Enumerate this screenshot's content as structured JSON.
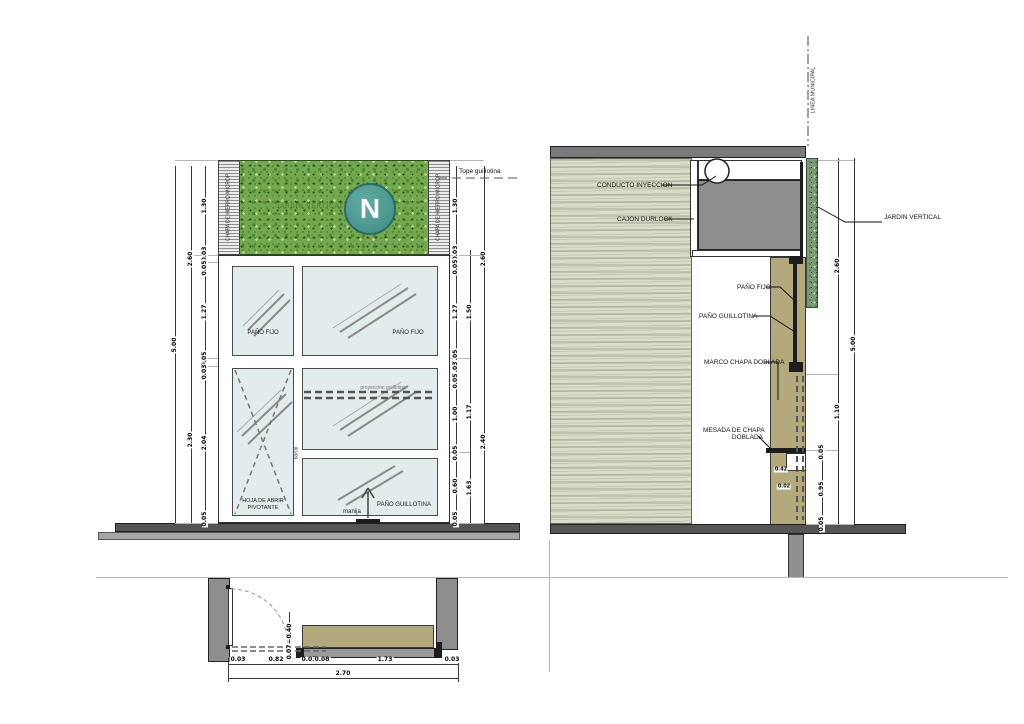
{
  "colors": {
    "garden_green": "#74a84e",
    "logo_teal": "#3f8a84",
    "khaki": "#b4a97c",
    "slab_gray": "#7a7a7a",
    "box_gray": "#8d8d8d",
    "floor_dark": "#555555",
    "glass": "#e2ecec"
  },
  "elevation": {
    "tope_label": "Tope guillotina",
    "garden_text": "JARDIN VERTICAL",
    "logo_letter": "N",
    "hatch_text": "CHAPA DE HIERRO MICROP.",
    "pane_fijo_left": "PAÑO FIJO",
    "pane_fijo_right": "PAÑO FIJO",
    "pane_guillotina": "PAÑO GUILLOTINA",
    "pivot_line1": "HOJA DE ABRIR",
    "pivot_line2": "PIVOTANTE",
    "handle": "manija",
    "projection": "proyeccion guillotina",
    "mullion": "barral",
    "dims_left_outer": [
      "5.00"
    ],
    "dims_left_mid": [
      "2.60",
      "2.30"
    ],
    "dims_left_inner": [
      "1.30",
      "0.03",
      "0.05",
      "1.27",
      "0.05",
      "0.03",
      "2.04",
      "0.05"
    ],
    "dims_right_inner": [
      "1.30",
      "0.03",
      "0.05",
      "1.27",
      "0.05",
      "0.03",
      "0.05",
      "1.00",
      "0.05",
      "0.60",
      "0.05"
    ],
    "dims_right_mid": [
      "1.50",
      "1.17",
      "1.63"
    ],
    "dims_right_outer": [
      "2.60",
      "2.40"
    ]
  },
  "section": {
    "labels": {
      "linea_municipal": "LINEA MUNICIPAL",
      "conducto": "CONDUCTO INYECCION",
      "cajon": "CAJON DURLOCK",
      "pano_fijo": "PAÑO FIJO",
      "pano_guillotina": "PAÑO GUILLOTINA",
      "marco": "MARCO CHAPA DOBLADA",
      "mesada_l1": "MESADA DE CHAPA",
      "mesada_l2": "DOBLADA",
      "jardin": "JARDIN VERTICAL"
    },
    "dims_inner": [
      "0.05",
      "0.95",
      "0.05"
    ],
    "dims_mid": [
      "2.60",
      "1.10"
    ],
    "dims_outer": [
      "5.00"
    ],
    "dims_mesada": [
      "0.42",
      "0.02"
    ]
  },
  "plan": {
    "dims_bottom": [
      "0.03",
      "0.82",
      "0.03",
      "0.08",
      "1.73",
      "0.03"
    ],
    "dim_total": "2.70",
    "dims_vertical": [
      "0.40",
      "0.07"
    ]
  }
}
